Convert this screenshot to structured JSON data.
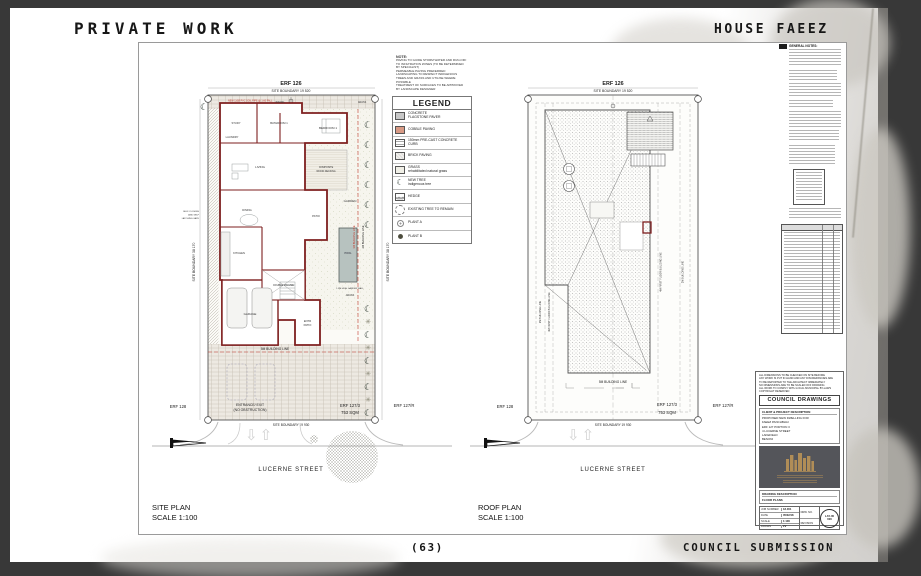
{
  "colors": {
    "wall_red": "#7e1f1f",
    "building_line_red": "#c23b2e",
    "cobble": "#d89a85",
    "pool": "#b7c2bf",
    "logo_gold": "#b08d57"
  },
  "page": {
    "top_left_title": "PRIVATE WORK",
    "top_right_title": "HOUSE FAEEZ",
    "page_number": "(63)",
    "bottom_right_title": "COUNCIL SUBMISSION"
  },
  "note_block": {
    "title": "NOTE:",
    "lines": [
      "PAVING TO GUIDE STORM WATER AND RUN-OFF",
      "TO INFILTRATION ZONES (TO BE DETERMINED",
      "BY SPECIALIST)",
      "PERMEABLE PAVING PREFERRED",
      "LANDSCAPING TO RESPECT INDIGENOUS",
      "TREES AND GRASS AND UTILISE WHERE",
      "POSSIBLE",
      "TREATMENT OF SURFACES TO BE APPROVED",
      "BY LANDSCAPE DESIGNER"
    ]
  },
  "legend": {
    "title": "LEGEND",
    "items": [
      {
        "l1": "CONCRETE",
        "l2": "FLAGSTONE PAVER"
      },
      {
        "l1": "COBBLE PAVING",
        "l2": ""
      },
      {
        "l1": "150mm PRE-CAST CONCRETE",
        "l2": "CURB"
      },
      {
        "l1": "BRICK PAVING",
        "l2": ""
      },
      {
        "l1": "GRASS",
        "l2": "rehabilitated natural grass"
      },
      {
        "l1": "NEW TREE",
        "l2": "indigenous tree"
      },
      {
        "l1": "HEDGE",
        "l2": ""
      },
      {
        "l1": "EXISTING TREE TO REMAIN",
        "l2": ""
      },
      {
        "l1": "PLANT A",
        "l2": ""
      },
      {
        "l1": "PLANT B",
        "l2": ""
      }
    ]
  },
  "site_plan": {
    "title": "SITE PLAN",
    "scale": "SCALE 1:100",
    "erf": "ERF 126",
    "boundary_top": "SITE BOUNDARY 19 520",
    "boundary_bottom": "SITE BOUNDARY 19 930",
    "boundary_left": "SITE BOUNDARY 38 170",
    "boundary_right": "SITE BOUNDARY 38 170",
    "erf_left": "ERF 128",
    "erf_right": "ERF 127/3",
    "erf_right_area": "753 SQM",
    "erf_far_right": "ERF 127/R",
    "street": "LUCERNE STREET",
    "entrance_line1": "ENTRANCE/ EXIT",
    "entrance_line2": "(NO OBSTRUCTION)",
    "line_5m": "5M BUILDING LINE",
    "line_3m": "3M BUILDING LINE",
    "line_2m": "2M BUILDING LINE",
    "garden_wall": "1.8M HIGH GARDEN WALL",
    "gate_note_1": "SELF CLOSING",
    "gate_note_2": "AND SELF",
    "gate_note_3": "LATCHING GATE",
    "soil_pipe": "NEW 110Ø PVC SOIL PIPE @ 1:60 FALL",
    "rooms": {
      "study": "STUDY",
      "bathroom": "BATHROOM 1",
      "bedroom": "BEDROOM 1",
      "living": "LIVING",
      "dining": "DINING",
      "kitchen": "KITCHEN",
      "laundry": "LAUNDRY",
      "garage": "GARAGE",
      "patio": "PATIO",
      "entr_patio_1": "ENTR",
      "entr_patio_2": "PATIO",
      "double_volume": "DOUBLE VOLUME",
      "deck_1": "COMPOSITE",
      "deck_2": "WOOD DECKING",
      "garden": "GARDEN",
      "pool": "POOL",
      "grass": "GRASS",
      "paving": "PAVING"
    }
  },
  "roof_plan": {
    "title": "ROOF PLAN",
    "scale": "SCALE 1:100",
    "erf": "ERF 126",
    "boundary_top": "SITE BOUNDARY 19 520",
    "boundary_bottom": "SITE BOUNDARY 19 930",
    "erf_left": "ERF 128",
    "erf_right": "ERF 127/3",
    "erf_right_area": "753 SQM",
    "erf_far_right": "ERF 127/R",
    "street": "LUCERNE STREET",
    "line_5m": "5M BUILDING LINE",
    "line_2m": "2M BUILDING LINE",
    "line_4m": "4M FIRST FLOOR BUILDING LINE"
  },
  "sidebar": {
    "general_notes": "GENERAL NOTES:"
  },
  "title_block": {
    "notes": [
      "ALL DIMENSIONS TO BE CHECKED ON SITE BEFORE",
      "ANY WORK IS PUT IN HAND AND ANY DISCREPANCIES ARE",
      "TO BE REPORTED TO THE ARCHITECT IMMEDIATELY",
      "NO DIMENSIONS ARE TO BE SCALED OFF DRAWING",
      "ALL WORK TO COMPLY WITH LOCAL MUNICIPAL BY-LAWS",
      "COPYRIGHT RESERVED"
    ],
    "header": "COUNCIL DRAWINGS",
    "client_header": "CLIENT & PROJECT DESCRIPTION",
    "client_lines": [
      "PROPOSED NEW DWELLING FOR",
      "FAEEZ PANCHBHAI",
      "ERF 127 PORTION 3",
      "4 LUCERNE STREET",
      "LAKEFIELD",
      "BENONI"
    ],
    "drawing_header": "DRAWING DESCRIPTION",
    "drawing": "FLOOR PLANS",
    "job_number_label": "JOB NUMBER",
    "job_number": "18-001",
    "date_label": "DATE",
    "date": "05/02/18",
    "scale_label": "SCALE",
    "scale": "1:100",
    "drawn_label": "DRAWN",
    "drawn": "ZV",
    "drw_no_label": "DRW. NO.",
    "revision_label": "REVISION",
    "stamp_line1": "LAY-00",
    "stamp_line2": "000"
  }
}
